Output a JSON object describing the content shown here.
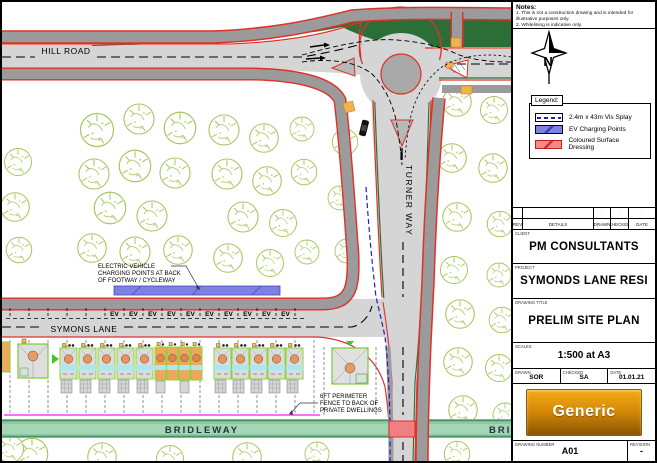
{
  "plan": {
    "road_labels": {
      "hill_road": "HILL ROAD",
      "turner_way": "TURNER WAY",
      "symons_lane": "SYMONS LANE",
      "bridleway": "BRIDLEWAY",
      "bridleway_east": "BRIDLEWAY"
    },
    "ev_bay_label": "EV",
    "annotations": {
      "ev_charging": [
        "ELECTRIC VEHICLE",
        "CHARGING POINTS AT BACK",
        "OF FOOTWAY / CYCLEWAY"
      ],
      "fence": [
        "6FT PERIMETER",
        "FENCE TO BACK OF",
        "PRIVATE DWELLINGS"
      ]
    },
    "colors": {
      "carriageway": "#d5d5d5",
      "footway": "#9b9b9b",
      "road_edge_red": "#e03028",
      "verge_green": "#2c6e38",
      "tree_green": "#a4c75e",
      "bridleway_green": "#8fc8a5",
      "ev_strip_blue": "#7d81e3",
      "vis_splay_blue": "#1f1fd0",
      "fence_magenta": "#f640f6",
      "surface_dressing": "#ee8080",
      "tactile_orange": "#f2b24c"
    }
  },
  "titleblock": {
    "notes": {
      "heading": "Notes:",
      "items": [
        "1.  This is not a construction drawing and is intended for illustrative purposes only.",
        "2.  Whitelining is indicative only."
      ]
    },
    "north_label": "N",
    "legend": {
      "heading": "Legend:",
      "items": [
        {
          "label": "2.4m x 43m Vis Splay"
        },
        {
          "label": "EV Charging Points"
        },
        {
          "label": "Coloured Surface Dressing"
        }
      ]
    },
    "revision_table": {
      "headers": [
        "REV",
        "DETAILS",
        "DRAWN",
        "CHECKED",
        "DATE"
      ],
      "empty_row": [
        "-",
        "",
        "-",
        "-",
        "-"
      ]
    },
    "client": {
      "label": "CLIENT",
      "value": "PM CONSULTANTS"
    },
    "project": {
      "label": "PROJECT",
      "value": "SYMONDS LANE RESI"
    },
    "drawing_title": {
      "label": "DRAWING TITLE",
      "value": "PRELIM SITE PLAN"
    },
    "scales": {
      "label": "SCALES",
      "value": "1:500 at A3"
    },
    "drawn": {
      "label": "DRAWN",
      "value": "SOR"
    },
    "checked": {
      "label": "CHECKED",
      "value": "SA"
    },
    "date": {
      "label": "DATE",
      "value": "01.01.21"
    },
    "logo_text": "Generic",
    "drawing_number": {
      "label": "DRAWING NUMBER",
      "value": "A01"
    },
    "revision": {
      "label": "REVISION",
      "value": "-"
    }
  }
}
